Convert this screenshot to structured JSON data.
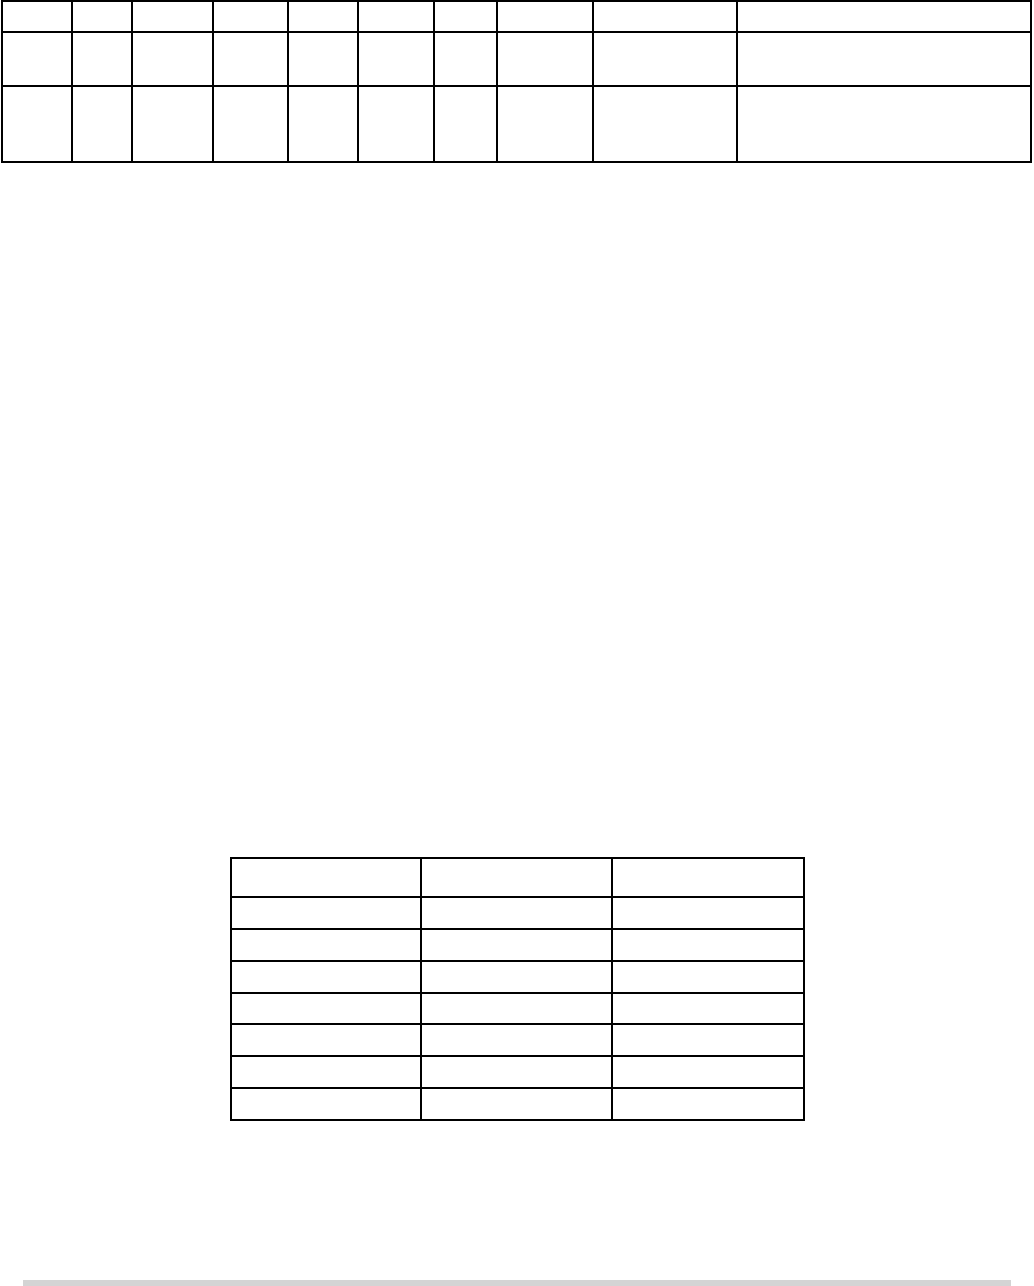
{
  "page": {
    "width": 1034,
    "height": 1286,
    "background": "#ffffff"
  },
  "top_table": {
    "x": 1,
    "y": 0,
    "border_color": "#000000",
    "column_widths": [
      70,
      60,
      81,
      75,
      70,
      76,
      63,
      96,
      144,
      294
    ],
    "row_heights": [
      31,
      54,
      76
    ],
    "cells": [
      [
        "",
        "",
        "",
        "",
        "",
        "",
        "",
        "",
        "",
        ""
      ],
      [
        "",
        "",
        "",
        "",
        "",
        "",
        "",
        "",
        "",
        ""
      ],
      [
        "",
        "",
        "",
        "",
        "",
        "",
        "",
        "",
        "",
        ""
      ]
    ]
  },
  "middle_table": {
    "x": 230,
    "y": 857,
    "border_color": "#000000",
    "column_widths": [
      190,
      191,
      192
    ],
    "row_heights": [
      39,
      32,
      32,
      32,
      31,
      32,
      32,
      32
    ],
    "cells": [
      [
        "",
        "",
        ""
      ],
      [
        "",
        "",
        ""
      ],
      [
        "",
        "",
        ""
      ],
      [
        "",
        "",
        ""
      ],
      [
        "",
        "",
        ""
      ],
      [
        "",
        "",
        ""
      ],
      [
        "",
        "",
        ""
      ],
      [
        "",
        "",
        ""
      ]
    ]
  },
  "footer_bar": {
    "x": 23,
    "y": 1280,
    "width": 988,
    "height": 6,
    "color": "#d4d4d4"
  }
}
